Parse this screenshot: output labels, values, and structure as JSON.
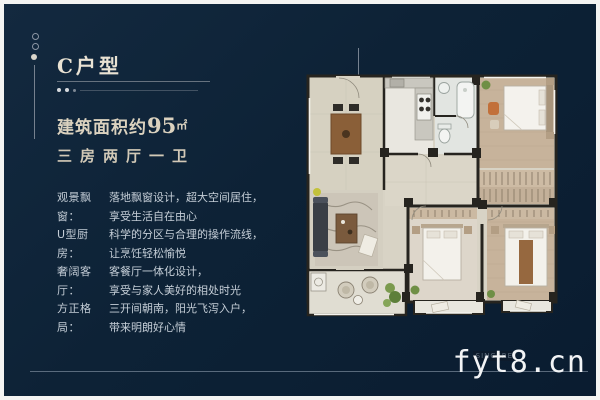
{
  "colors": {
    "background_navy": "#0d2236",
    "frame_white": "#f4f4f2",
    "title_cream": "#e9e2d3",
    "area_gold": "#dbd2bf",
    "body_text": "#c5ced7",
    "rule_gray": "#66727f",
    "plan_floor_beige": "#d8d3c5",
    "plan_wood": "#c7b39b",
    "plan_wall_dark": "#26241f",
    "watermark_white": "#f2f4f6"
  },
  "unit_panel": {
    "title": "C户型",
    "area_prefix": "建筑面积约",
    "area_value": "95",
    "area_unit": "㎡",
    "layout_line": "三房两厅一卫",
    "features": [
      {
        "label": "观景飘窗：",
        "line1": "落地飘窗设计，超大空间居住，",
        "line2": "享受生活自在由心"
      },
      {
        "label": "U型厨房：",
        "line1": "科学的分区与合理的操作流线，",
        "line2": "让烹饪轻松愉悦"
      },
      {
        "label": "奢阔客厅：",
        "line1": "客餐厅一体化设计，",
        "line2": "享受与家人美好的相处时光"
      },
      {
        "label": "方正格局：",
        "line1": "三开间朝南，阳光飞泻入户，",
        "line2": "带来明朗好心情"
      }
    ]
  },
  "footer": {
    "watermark": "fyt8.cn",
    "watermark_overlay": "SINCERE"
  }
}
